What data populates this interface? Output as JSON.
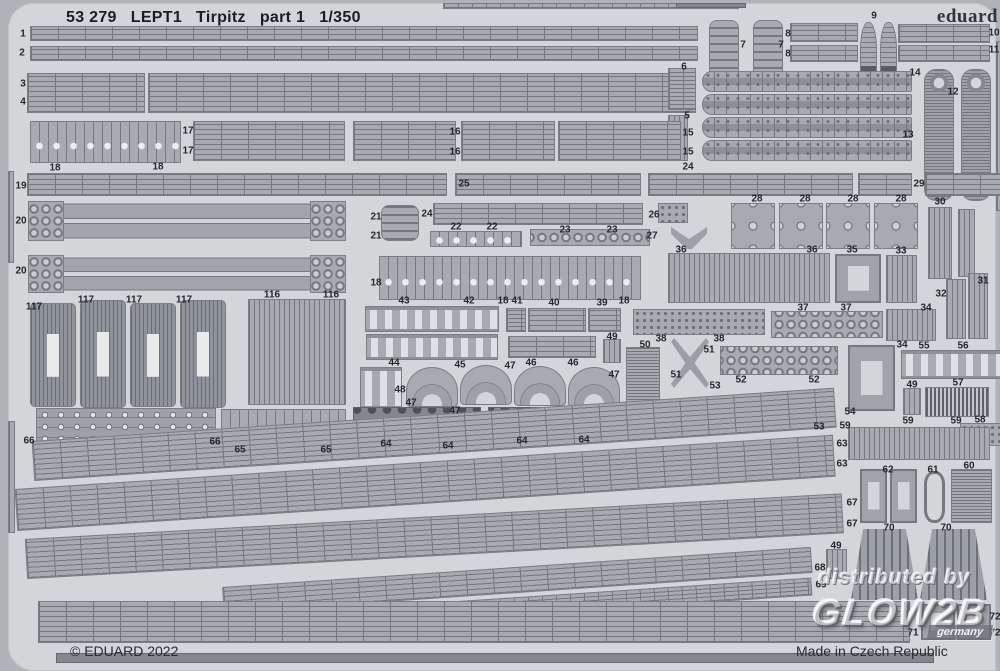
{
  "header": {
    "catalog_number": "53 279",
    "plate_code": "LEPT1",
    "kit_name": "Tirpitz",
    "part_label": "part 1",
    "scale": "1/350"
  },
  "brand": {
    "logo_text": "eduard"
  },
  "footer": {
    "copyright": "© EDUARD 2022",
    "made_in": "Made in Czech Republic"
  },
  "watermark": {
    "prefix": "distributed by",
    "brand": "GLOW2B",
    "region": "germany"
  },
  "colors": {
    "page_bg": "#b0b2b7",
    "sheet_bg": "#d3d5d9",
    "part_fill": "#a7aab1",
    "part_line": "#74777e",
    "dark_part": "#84878e",
    "text": "#26272b"
  },
  "labels": [
    {
      "t": "1",
      "x": 15,
      "y": 31
    },
    {
      "t": "2",
      "x": 14,
      "y": 50
    },
    {
      "t": "3",
      "x": 15,
      "y": 81
    },
    {
      "t": "4",
      "x": 15,
      "y": 99
    },
    {
      "t": "18",
      "x": 47,
      "y": 165
    },
    {
      "t": "18",
      "x": 150,
      "y": 164
    },
    {
      "t": "17",
      "x": 180,
      "y": 128
    },
    {
      "t": "17",
      "x": 180,
      "y": 148
    },
    {
      "t": "16",
      "x": 447,
      "y": 129
    },
    {
      "t": "16",
      "x": 447,
      "y": 149
    },
    {
      "t": "15",
      "x": 680,
      "y": 130
    },
    {
      "t": "15",
      "x": 680,
      "y": 149
    },
    {
      "t": "6",
      "x": 676,
      "y": 64
    },
    {
      "t": "5",
      "x": 679,
      "y": 113
    },
    {
      "t": "7",
      "x": 735,
      "y": 42
    },
    {
      "t": "7",
      "x": 773,
      "y": 42
    },
    {
      "t": "8",
      "x": 780,
      "y": 31
    },
    {
      "t": "8",
      "x": 780,
      "y": 51
    },
    {
      "t": "9",
      "x": 866,
      "y": 13
    },
    {
      "t": "10",
      "x": 986,
      "y": 30
    },
    {
      "t": "11",
      "x": 986,
      "y": 47
    },
    {
      "t": "14",
      "x": 907,
      "y": 70
    },
    {
      "t": "12",
      "x": 945,
      "y": 89
    },
    {
      "t": "13",
      "x": 900,
      "y": 132
    },
    {
      "t": "19",
      "x": 13,
      "y": 183
    },
    {
      "t": "25",
      "x": 456,
      "y": 181
    },
    {
      "t": "24",
      "x": 680,
      "y": 164
    },
    {
      "t": "29",
      "x": 911,
      "y": 181
    },
    {
      "t": "24",
      "x": 419,
      "y": 211
    },
    {
      "t": "20",
      "x": 13,
      "y": 218
    },
    {
      "t": "21",
      "x": 368,
      "y": 214
    },
    {
      "t": "21",
      "x": 368,
      "y": 233
    },
    {
      "t": "26",
      "x": 646,
      "y": 212
    },
    {
      "t": "27",
      "x": 644,
      "y": 233
    },
    {
      "t": "22",
      "x": 448,
      "y": 224
    },
    {
      "t": "22",
      "x": 484,
      "y": 224
    },
    {
      "t": "23",
      "x": 557,
      "y": 227
    },
    {
      "t": "23",
      "x": 604,
      "y": 227
    },
    {
      "t": "28",
      "x": 749,
      "y": 196
    },
    {
      "t": "28",
      "x": 797,
      "y": 196
    },
    {
      "t": "28",
      "x": 845,
      "y": 196
    },
    {
      "t": "28",
      "x": 893,
      "y": 196
    },
    {
      "t": "30",
      "x": 932,
      "y": 199
    },
    {
      "t": "36",
      "x": 673,
      "y": 247
    },
    {
      "t": "36",
      "x": 804,
      "y": 247
    },
    {
      "t": "35",
      "x": 844,
      "y": 247
    },
    {
      "t": "33",
      "x": 893,
      "y": 248
    },
    {
      "t": "20",
      "x": 13,
      "y": 268
    },
    {
      "t": "116",
      "x": 264,
      "y": 292
    },
    {
      "t": "116",
      "x": 323,
      "y": 292
    },
    {
      "t": "117",
      "x": 26,
      "y": 304
    },
    {
      "t": "117",
      "x": 78,
      "y": 297
    },
    {
      "t": "117",
      "x": 126,
      "y": 297
    },
    {
      "t": "117",
      "x": 176,
      "y": 297
    },
    {
      "t": "18",
      "x": 368,
      "y": 280
    },
    {
      "t": "43",
      "x": 396,
      "y": 298
    },
    {
      "t": "42",
      "x": 461,
      "y": 298
    },
    {
      "t": "18",
      "x": 495,
      "y": 298
    },
    {
      "t": "41",
      "x": 509,
      "y": 298
    },
    {
      "t": "40",
      "x": 546,
      "y": 300
    },
    {
      "t": "39",
      "x": 594,
      "y": 300
    },
    {
      "t": "18",
      "x": 616,
      "y": 298
    },
    {
      "t": "44",
      "x": 386,
      "y": 360
    },
    {
      "t": "45",
      "x": 452,
      "y": 362
    },
    {
      "t": "46",
      "x": 523,
      "y": 360
    },
    {
      "t": "46",
      "x": 565,
      "y": 360
    },
    {
      "t": "47",
      "x": 502,
      "y": 363
    },
    {
      "t": "47",
      "x": 606,
      "y": 372
    },
    {
      "t": "47",
      "x": 403,
      "y": 400
    },
    {
      "t": "47",
      "x": 447,
      "y": 408
    },
    {
      "t": "48",
      "x": 392,
      "y": 387
    },
    {
      "t": "49",
      "x": 604,
      "y": 334
    },
    {
      "t": "38",
      "x": 653,
      "y": 336
    },
    {
      "t": "38",
      "x": 711,
      "y": 336
    },
    {
      "t": "50",
      "x": 637,
      "y": 342
    },
    {
      "t": "51",
      "x": 701,
      "y": 347
    },
    {
      "t": "51",
      "x": 668,
      "y": 372
    },
    {
      "t": "37",
      "x": 795,
      "y": 305
    },
    {
      "t": "37",
      "x": 838,
      "y": 305
    },
    {
      "t": "34",
      "x": 918,
      "y": 305
    },
    {
      "t": "34",
      "x": 894,
      "y": 342
    },
    {
      "t": "55",
      "x": 916,
      "y": 343
    },
    {
      "t": "56",
      "x": 955,
      "y": 343
    },
    {
      "t": "31",
      "x": 975,
      "y": 278
    },
    {
      "t": "32",
      "x": 933,
      "y": 291
    },
    {
      "t": "52",
      "x": 733,
      "y": 377
    },
    {
      "t": "52",
      "x": 806,
      "y": 377
    },
    {
      "t": "53",
      "x": 707,
      "y": 383
    },
    {
      "t": "53",
      "x": 811,
      "y": 424
    },
    {
      "t": "54",
      "x": 842,
      "y": 409
    },
    {
      "t": "49",
      "x": 904,
      "y": 382
    },
    {
      "t": "57",
      "x": 950,
      "y": 380
    },
    {
      "t": "59",
      "x": 900,
      "y": 418
    },
    {
      "t": "59",
      "x": 948,
      "y": 418
    },
    {
      "t": "58",
      "x": 972,
      "y": 417
    },
    {
      "t": "59",
      "x": 837,
      "y": 423
    },
    {
      "t": "63",
      "x": 834,
      "y": 441
    },
    {
      "t": "63",
      "x": 834,
      "y": 461
    },
    {
      "t": "60",
      "x": 961,
      "y": 463
    },
    {
      "t": "62",
      "x": 880,
      "y": 467
    },
    {
      "t": "61",
      "x": 925,
      "y": 467
    },
    {
      "t": "64",
      "x": 378,
      "y": 441
    },
    {
      "t": "64",
      "x": 440,
      "y": 443
    },
    {
      "t": "64",
      "x": 514,
      "y": 438
    },
    {
      "t": "64",
      "x": 576,
      "y": 437
    },
    {
      "t": "66",
      "x": 21,
      "y": 438
    },
    {
      "t": "66",
      "x": 207,
      "y": 439
    },
    {
      "t": "65",
      "x": 232,
      "y": 447
    },
    {
      "t": "65",
      "x": 318,
      "y": 447
    },
    {
      "t": "67",
      "x": 844,
      "y": 500
    },
    {
      "t": "67",
      "x": 844,
      "y": 521
    },
    {
      "t": "70",
      "x": 881,
      "y": 525
    },
    {
      "t": "70",
      "x": 938,
      "y": 525
    },
    {
      "t": "49",
      "x": 828,
      "y": 543
    },
    {
      "t": "68",
      "x": 812,
      "y": 565
    },
    {
      "t": "69",
      "x": 813,
      "y": 582
    },
    {
      "t": "71",
      "x": 905,
      "y": 630
    },
    {
      "t": "72",
      "x": 987,
      "y": 614
    },
    {
      "t": "72",
      "x": 987,
      "y": 630
    }
  ],
  "shapes": [
    {
      "x": 435,
      "y": 0,
      "w": 296,
      "h": 6,
      "p": "railf"
    },
    {
      "x": 668,
      "y": 0,
      "w": 70,
      "h": 5,
      "p": "edge"
    },
    {
      "x": 22,
      "y": 23,
      "w": 668,
      "h": 15,
      "p": "rail"
    },
    {
      "x": 22,
      "y": 43,
      "w": 668,
      "h": 15,
      "p": "rail"
    },
    {
      "x": 19,
      "y": 70,
      "w": 118,
      "h": 40,
      "p": "rail"
    },
    {
      "x": 140,
      "y": 70,
      "w": 548,
      "h": 40,
      "p": "rail"
    },
    {
      "x": 701,
      "y": 17,
      "w": 30,
      "h": 58,
      "p": "ladder"
    },
    {
      "x": 745,
      "y": 17,
      "w": 30,
      "h": 58,
      "p": "ladder"
    },
    {
      "x": 782,
      "y": 20,
      "w": 68,
      "h": 19,
      "p": "rail"
    },
    {
      "x": 782,
      "y": 42,
      "w": 68,
      "h": 17,
      "p": "rail"
    },
    {
      "x": 852,
      "y": 19,
      "w": 17,
      "h": 62,
      "p": "bottle"
    },
    {
      "x": 872,
      "y": 19,
      "w": 17,
      "h": 62,
      "p": "bottle"
    },
    {
      "x": 890,
      "y": 21,
      "w": 92,
      "h": 19,
      "p": "rail"
    },
    {
      "x": 890,
      "y": 42,
      "w": 92,
      "h": 17,
      "p": "rail"
    },
    {
      "x": 694,
      "y": 68,
      "w": 210,
      "h": 21,
      "p": "walk"
    },
    {
      "x": 694,
      "y": 91,
      "w": 210,
      "h": 21,
      "p": "walk"
    },
    {
      "x": 694,
      "y": 114,
      "w": 210,
      "h": 21,
      "p": "walk"
    },
    {
      "x": 694,
      "y": 137,
      "w": 210,
      "h": 21,
      "p": "walk"
    },
    {
      "x": 916,
      "y": 66,
      "w": 30,
      "h": 132,
      "p": "tower"
    },
    {
      "x": 953,
      "y": 66,
      "w": 30,
      "h": 132,
      "p": "tower"
    },
    {
      "x": 988,
      "y": 38,
      "w": 9,
      "h": 170,
      "p": "comb"
    },
    {
      "x": 993,
      "y": 245,
      "w": 7,
      "h": 95,
      "p": "comb"
    },
    {
      "x": 660,
      "y": 65,
      "w": 28,
      "h": 42,
      "p": "railf"
    },
    {
      "x": 660,
      "y": 112,
      "w": 20,
      "h": 46,
      "p": "comb"
    },
    {
      "x": 22,
      "y": 118,
      "w": 151,
      "h": 42,
      "p": "cleat"
    },
    {
      "x": 185,
      "y": 118,
      "w": 152,
      "h": 40,
      "p": "rail"
    },
    {
      "x": 345,
      "y": 118,
      "w": 103,
      "h": 40,
      "p": "rail"
    },
    {
      "x": 453,
      "y": 118,
      "w": 94,
      "h": 40,
      "p": "rail"
    },
    {
      "x": 550,
      "y": 118,
      "w": 123,
      "h": 40,
      "p": "rail"
    },
    {
      "x": 19,
      "y": 170,
      "w": 420,
      "h": 23,
      "p": "rail"
    },
    {
      "x": 447,
      "y": 170,
      "w": 186,
      "h": 23,
      "p": "rail"
    },
    {
      "x": 640,
      "y": 170,
      "w": 205,
      "h": 23,
      "p": "rail"
    },
    {
      "x": 850,
      "y": 170,
      "w": 54,
      "h": 23,
      "p": "rail"
    },
    {
      "x": 917,
      "y": 170,
      "w": 80,
      "h": 23,
      "p": "rail"
    },
    {
      "x": 20,
      "y": 198,
      "w": 318,
      "h": 40,
      "p": "thick"
    },
    {
      "x": 20,
      "y": 198,
      "w": 36,
      "h": 40,
      "p": "circ"
    },
    {
      "x": 302,
      "y": 198,
      "w": 36,
      "h": 40,
      "p": "circ"
    },
    {
      "x": 20,
      "y": 252,
      "w": 318,
      "h": 38,
      "p": "thick"
    },
    {
      "x": 20,
      "y": 252,
      "w": 36,
      "h": 38,
      "p": "circ"
    },
    {
      "x": 302,
      "y": 252,
      "w": 36,
      "h": 38,
      "p": "circ"
    },
    {
      "x": 373,
      "y": 202,
      "w": 38,
      "h": 36,
      "p": "ladder"
    },
    {
      "x": 425,
      "y": 200,
      "w": 210,
      "h": 22,
      "p": "rail"
    },
    {
      "x": 650,
      "y": 200,
      "w": 30,
      "h": 20,
      "p": "dots"
    },
    {
      "x": 663,
      "y": 224,
      "w": 36,
      "h": 22,
      "p": "vee"
    },
    {
      "x": 723,
      "y": 200,
      "w": 44,
      "h": 46,
      "p": "pairs"
    },
    {
      "x": 771,
      "y": 200,
      "w": 44,
      "h": 46,
      "p": "pairs"
    },
    {
      "x": 818,
      "y": 200,
      "w": 44,
      "h": 46,
      "p": "pairs"
    },
    {
      "x": 866,
      "y": 200,
      "w": 44,
      "h": 46,
      "p": "pairs"
    },
    {
      "x": 920,
      "y": 204,
      "w": 24,
      "h": 72,
      "p": "comb"
    },
    {
      "x": 950,
      "y": 206,
      "w": 17,
      "h": 68,
      "p": "comb"
    },
    {
      "x": 422,
      "y": 228,
      "w": 92,
      "h": 16,
      "p": "cleat"
    },
    {
      "x": 522,
      "y": 226,
      "w": 120,
      "h": 17,
      "p": "circ"
    },
    {
      "x": 371,
      "y": 253,
      "w": 262,
      "h": 44,
      "p": "cleat"
    },
    {
      "x": 660,
      "y": 250,
      "w": 162,
      "h": 50,
      "p": "comb"
    },
    {
      "x": 827,
      "y": 251,
      "w": 46,
      "h": 49,
      "p": "frame"
    },
    {
      "x": 878,
      "y": 252,
      "w": 31,
      "h": 48,
      "p": "comb"
    },
    {
      "x": 240,
      "y": 296,
      "w": 98,
      "h": 106,
      "p": "comb"
    },
    {
      "x": 22,
      "y": 300,
      "w": 46,
      "h": 104,
      "p": "turret"
    },
    {
      "x": 72,
      "y": 297,
      "w": 46,
      "h": 108,
      "p": "turret"
    },
    {
      "x": 122,
      "y": 300,
      "w": 46,
      "h": 104,
      "p": "turret"
    },
    {
      "x": 172,
      "y": 297,
      "w": 46,
      "h": 108,
      "p": "turret"
    },
    {
      "x": 357,
      "y": 303,
      "w": 134,
      "h": 26,
      "p": "arch"
    },
    {
      "x": 498,
      "y": 305,
      "w": 20,
      "h": 24,
      "p": "railf"
    },
    {
      "x": 520,
      "y": 305,
      "w": 58,
      "h": 24,
      "p": "rail"
    },
    {
      "x": 580,
      "y": 305,
      "w": 33,
      "h": 24,
      "p": "rail"
    },
    {
      "x": 625,
      "y": 306,
      "w": 132,
      "h": 26,
      "p": "dots"
    },
    {
      "x": 358,
      "y": 331,
      "w": 132,
      "h": 26,
      "p": "arch"
    },
    {
      "x": 500,
      "y": 333,
      "w": 88,
      "h": 22,
      "p": "rail"
    },
    {
      "x": 595,
      "y": 336,
      "w": 18,
      "h": 24,
      "p": "comb"
    },
    {
      "x": 618,
      "y": 344,
      "w": 34,
      "h": 84,
      "p": "hatch"
    },
    {
      "x": 663,
      "y": 335,
      "w": 38,
      "h": 50,
      "p": "xstar"
    },
    {
      "x": 763,
      "y": 308,
      "w": 112,
      "h": 27,
      "p": "circ"
    },
    {
      "x": 878,
      "y": 306,
      "w": 50,
      "h": 32,
      "p": "comb"
    },
    {
      "x": 938,
      "y": 276,
      "w": 20,
      "h": 60,
      "p": "comb"
    },
    {
      "x": 960,
      "y": 270,
      "w": 20,
      "h": 66,
      "p": "comb"
    },
    {
      "x": 893,
      "y": 347,
      "w": 103,
      "h": 29,
      "p": "arch"
    },
    {
      "x": 712,
      "y": 343,
      "w": 118,
      "h": 29,
      "p": "circ"
    },
    {
      "x": 840,
      "y": 342,
      "w": 47,
      "h": 66,
      "p": "frame"
    },
    {
      "x": 895,
      "y": 385,
      "w": 18,
      "h": 27,
      "p": "comb"
    },
    {
      "x": 917,
      "y": 384,
      "w": 64,
      "h": 30,
      "p": "combd"
    },
    {
      "x": 952,
      "y": 420,
      "w": 46,
      "h": 23,
      "p": "dots"
    },
    {
      "x": 840,
      "y": 424,
      "w": 142,
      "h": 33,
      "p": "comb"
    },
    {
      "x": 943,
      "y": 466,
      "w": 41,
      "h": 54,
      "p": "hatch"
    },
    {
      "x": 916,
      "y": 468,
      "w": 21,
      "h": 52,
      "p": "cee"
    },
    {
      "x": 852,
      "y": 466,
      "w": 27,
      "h": 54,
      "p": "frame"
    },
    {
      "x": 882,
      "y": 466,
      "w": 27,
      "h": 54,
      "p": "frame"
    },
    {
      "x": 352,
      "y": 364,
      "w": 42,
      "h": 42,
      "p": "arch"
    },
    {
      "x": 398,
      "y": 364,
      "w": 52,
      "h": 40,
      "p": "fan"
    },
    {
      "x": 452,
      "y": 362,
      "w": 52,
      "h": 40,
      "p": "fan"
    },
    {
      "x": 506,
      "y": 363,
      "w": 52,
      "h": 40,
      "p": "fan"
    },
    {
      "x": 560,
      "y": 364,
      "w": 52,
      "h": 40,
      "p": "fan"
    },
    {
      "x": 345,
      "y": 404,
      "w": 128,
      "h": 37,
      "p": "dark"
    },
    {
      "x": 480,
      "y": 404,
      "w": 124,
      "h": 34,
      "p": "dark"
    },
    {
      "x": 28,
      "y": 405,
      "w": 180,
      "h": 40,
      "p": "mech"
    },
    {
      "x": 213,
      "y": 406,
      "w": 125,
      "h": 38,
      "p": "cleat"
    },
    {
      "x": 0,
      "y": 168,
      "w": 6,
      "h": 92,
      "p": "comb"
    },
    {
      "x": 0,
      "y": 418,
      "w": 7,
      "h": 112,
      "p": "comb"
    },
    {
      "x": 25,
      "y": 438,
      "w": 804,
      "h": 40,
      "p": "rail",
      "r": -3.8
    },
    {
      "x": 8,
      "y": 486,
      "w": 820,
      "h": 42,
      "p": "rail",
      "r": -3.8
    },
    {
      "x": 18,
      "y": 536,
      "w": 818,
      "h": 40,
      "p": "rail",
      "r": -3.2
    },
    {
      "x": 215,
      "y": 584,
      "w": 590,
      "h": 26,
      "p": "rail",
      "r": -3.9
    },
    {
      "x": 240,
      "y": 612,
      "w": 565,
      "h": 18,
      "p": "railf",
      "r": -3.8
    },
    {
      "x": 818,
      "y": 546,
      "w": 21,
      "h": 30,
      "p": "comb"
    },
    {
      "x": 843,
      "y": 526,
      "w": 67,
      "h": 71,
      "p": "trap"
    },
    {
      "x": 912,
      "y": 526,
      "w": 67,
      "h": 71,
      "p": "trap"
    },
    {
      "x": 30,
      "y": 598,
      "w": 872,
      "h": 42,
      "p": "rail"
    },
    {
      "x": 913,
      "y": 601,
      "w": 34,
      "h": 36,
      "p": "frame"
    },
    {
      "x": 949,
      "y": 601,
      "w": 34,
      "h": 36,
      "p": "frame"
    },
    {
      "x": 48,
      "y": 650,
      "w": 878,
      "h": 10,
      "p": "edge"
    }
  ]
}
